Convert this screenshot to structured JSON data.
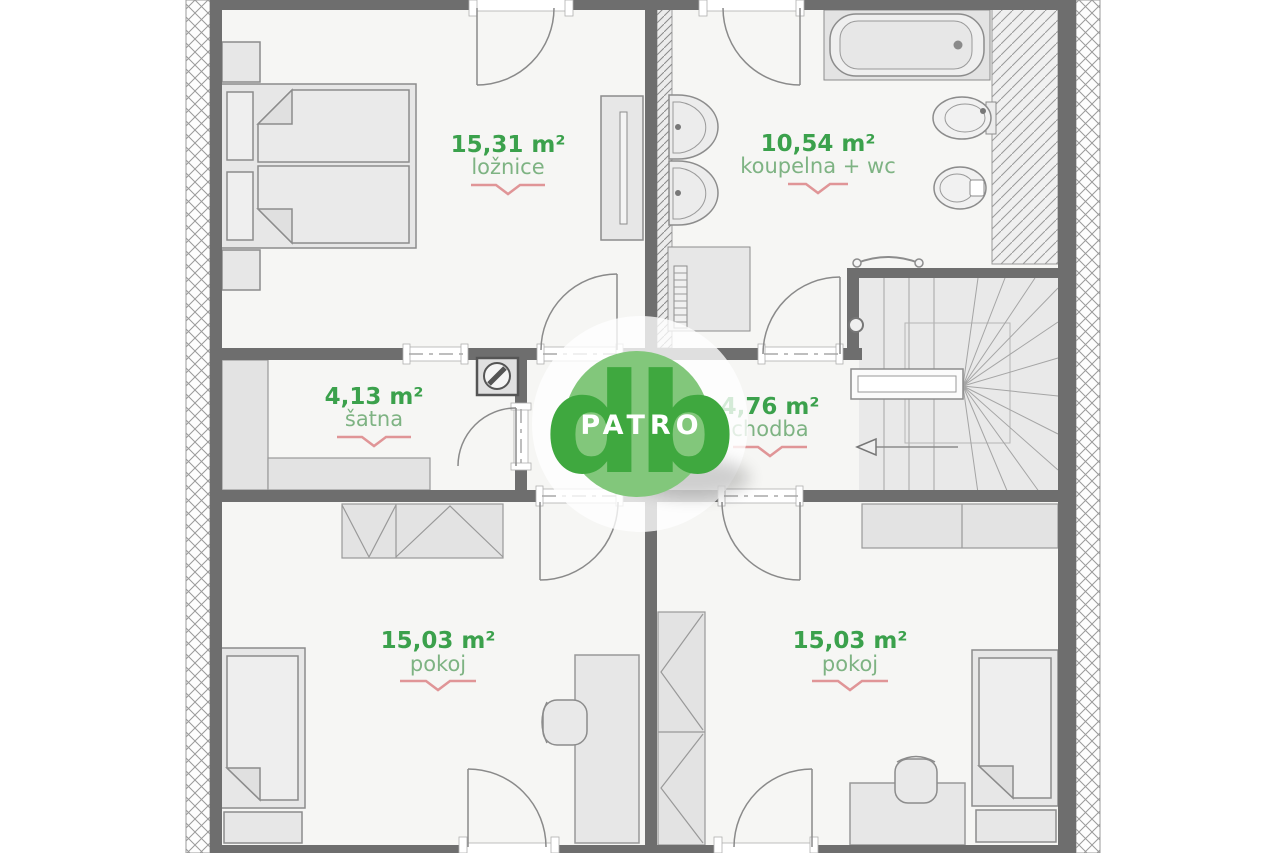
{
  "plan": {
    "title": "floor-plan-patro",
    "logo": {
      "monogram": "db",
      "label": "PATRO"
    },
    "rooms": [
      {
        "id": "loznice",
        "area": "15,31 m²",
        "name": "ložnice"
      },
      {
        "id": "koupelna",
        "area": "10,54 m²",
        "name": "koupelna + wc"
      },
      {
        "id": "satna",
        "area": "4,13 m²",
        "name": "šatna"
      },
      {
        "id": "chodba",
        "area": "4,76 m²",
        "name": "chodba"
      },
      {
        "id": "pokoj1",
        "area": "15,03 m²",
        "name": "pokoj"
      },
      {
        "id": "pokoj2",
        "area": "15,03 m²",
        "name": "pokoj"
      }
    ],
    "colors": {
      "accent_green": "#3ba14c",
      "name_green": "#7eb383",
      "underline_red": "#e09597",
      "wall_gray": "#6e6e6e",
      "furniture_gray": "#e7e7e7",
      "logo_circle_green": "#82c77b",
      "logo_text_green": "#3fa83f"
    }
  }
}
